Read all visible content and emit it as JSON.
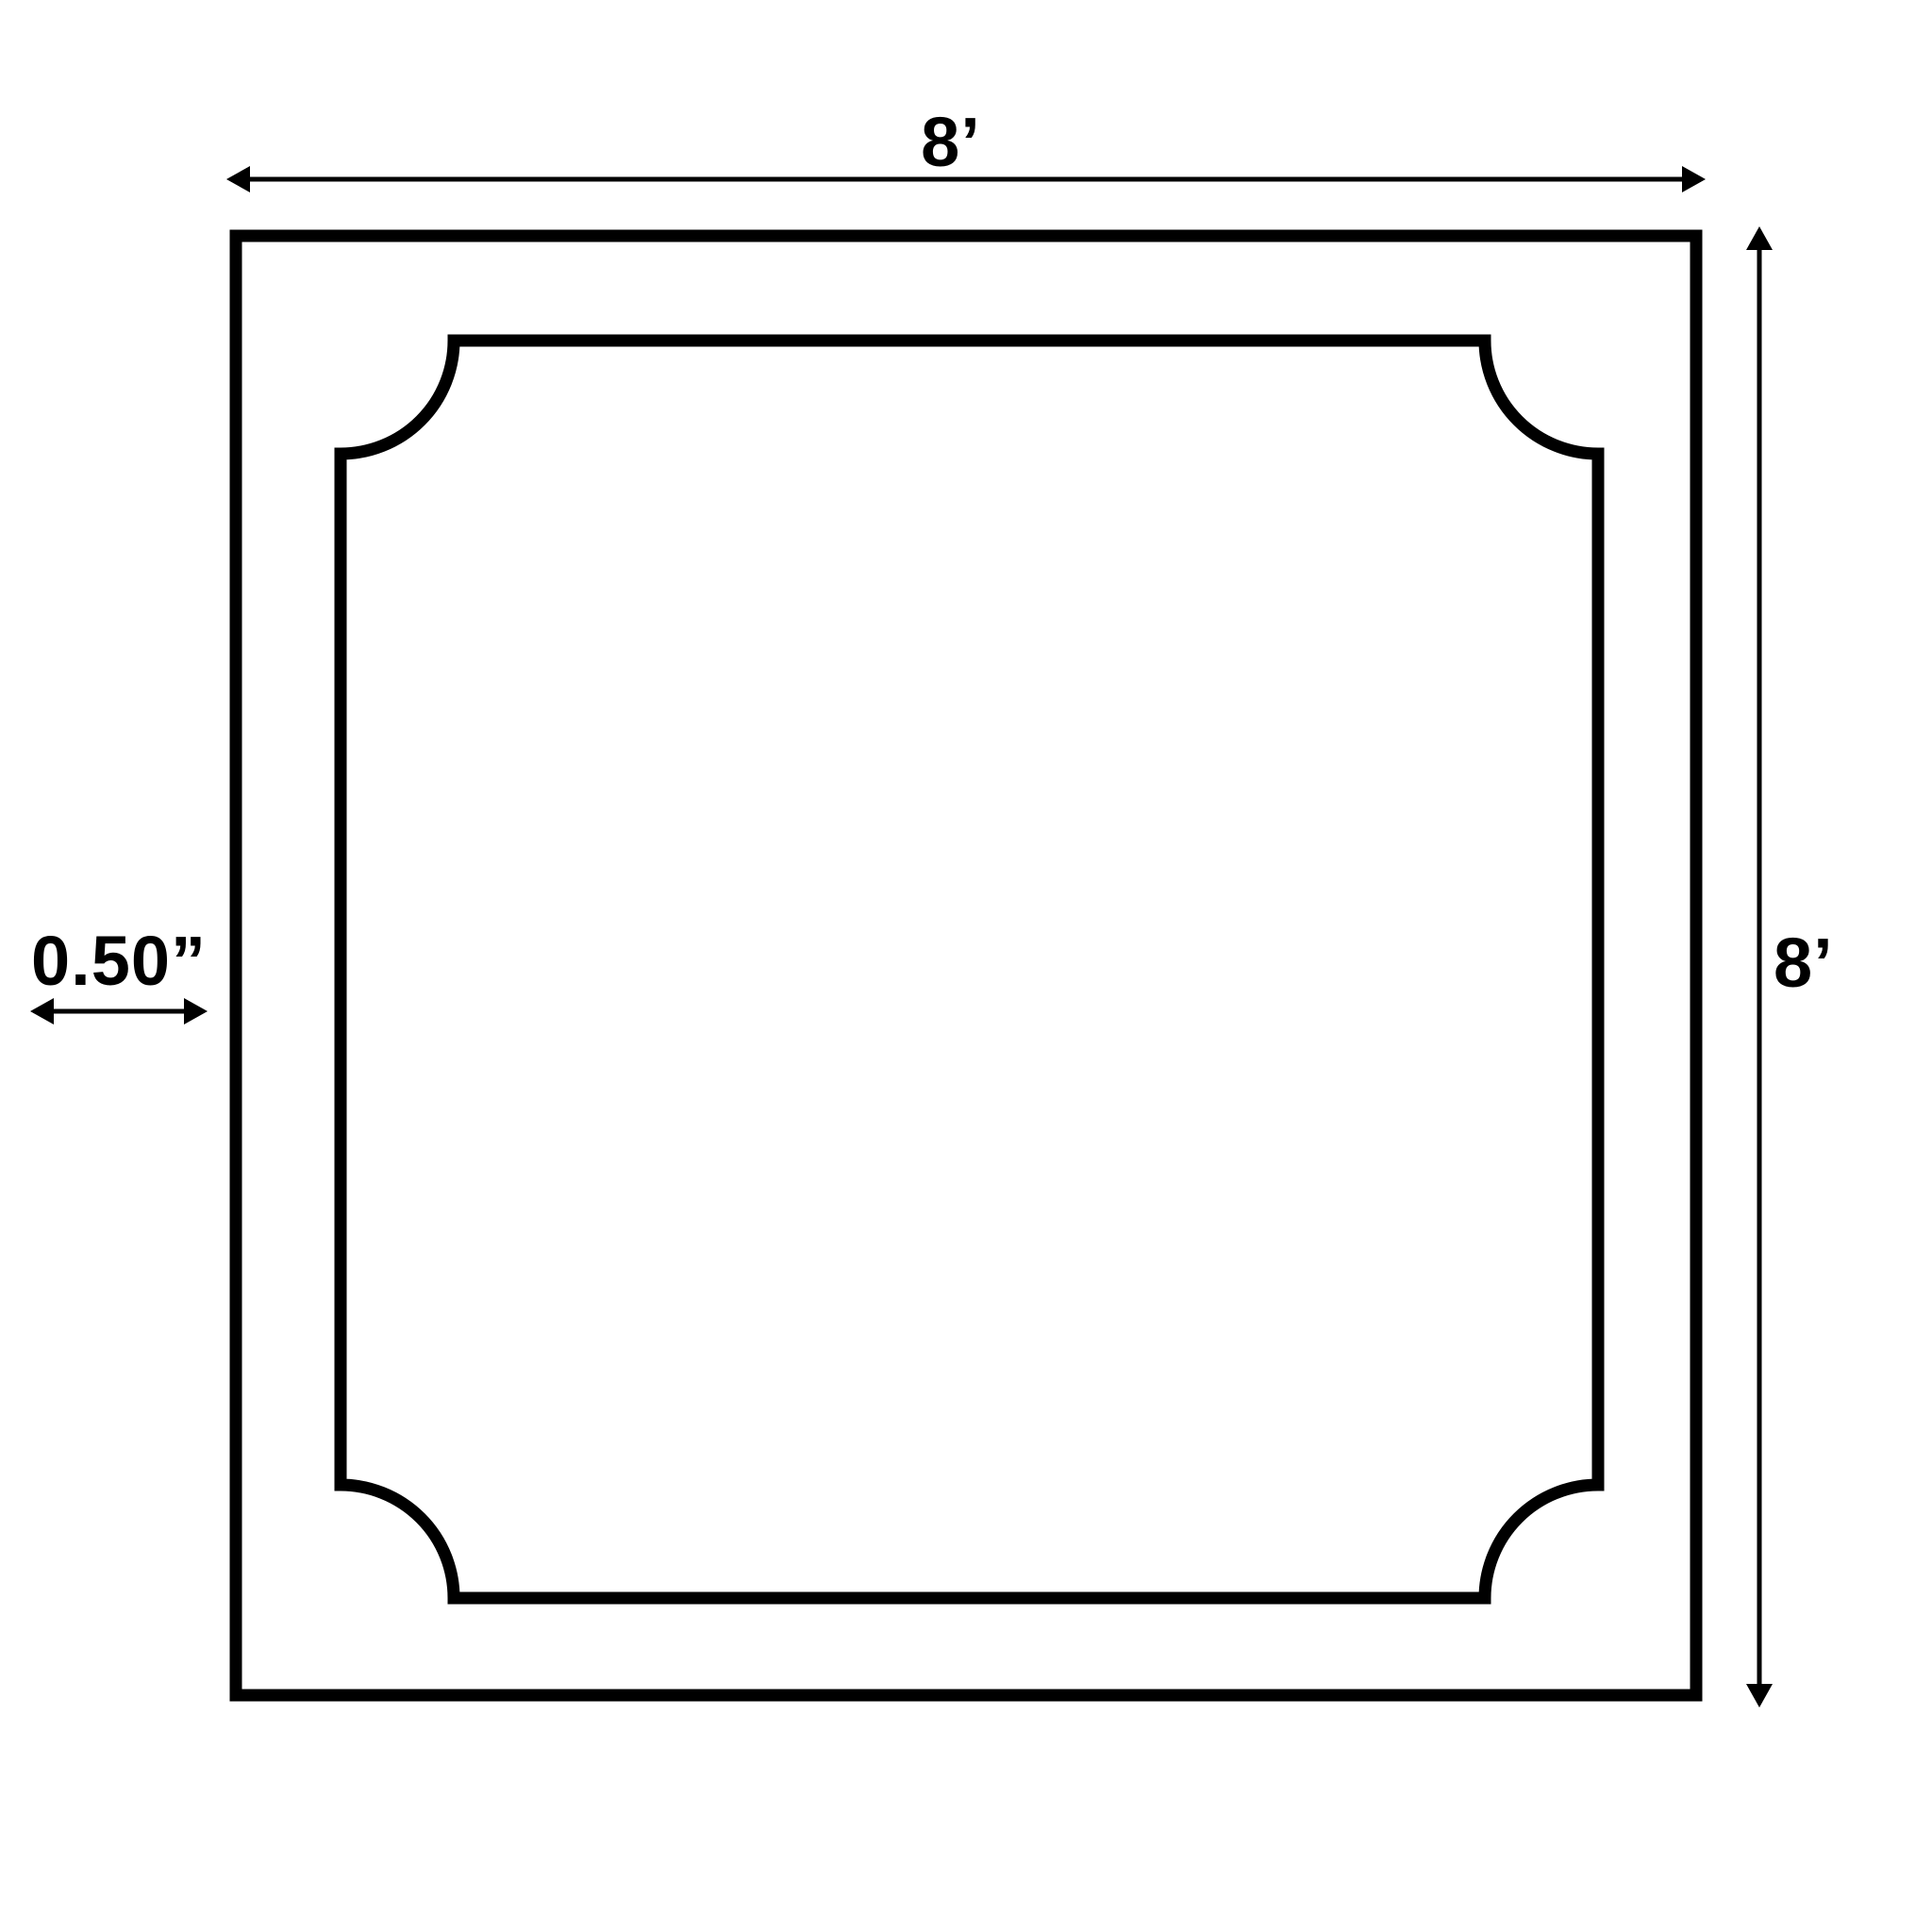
{
  "diagram": {
    "background_color": "#ffffff",
    "ink_color": "#000000",
    "panel": {
      "width_label": "8’",
      "height_label": "8’",
      "moulding_offset_label": "0.50”"
    }
  }
}
